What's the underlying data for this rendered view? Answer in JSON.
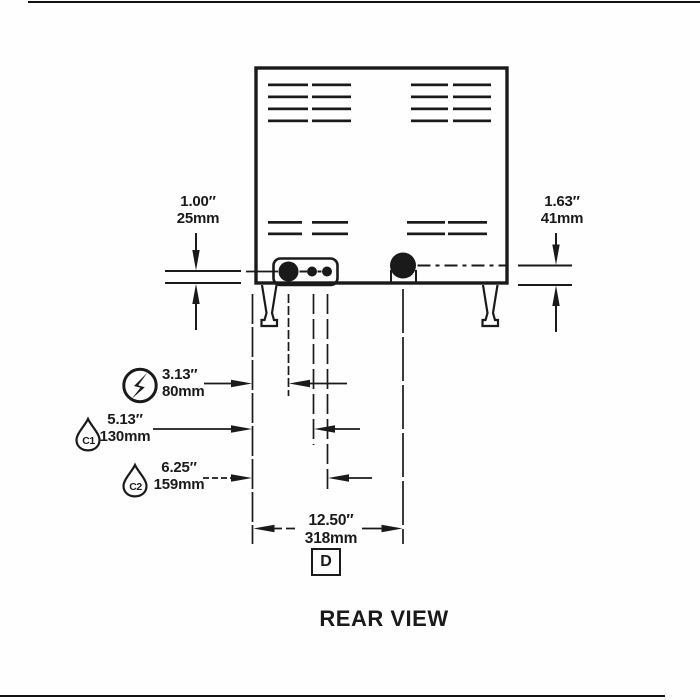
{
  "page": {
    "title": "REAR VIEW"
  },
  "detail_ref": "D",
  "dims": {
    "left": {
      "inches": "1.00″",
      "metric": "25mm"
    },
    "right": {
      "inches": "1.63″",
      "metric": "41mm"
    },
    "electrical": {
      "inches": "3.13″",
      "metric": "80mm"
    },
    "c1": {
      "inches": "5.13″",
      "metric": "130mm"
    },
    "c2": {
      "inches": "6.25″",
      "metric": "159mm"
    },
    "width": {
      "inches": "12.50″",
      "metric": "318mm"
    }
  },
  "icons": {
    "electrical": "lightning-bolt",
    "c1": "C1",
    "c2": "C2"
  },
  "colors": {
    "ink": "#1a1a1a",
    "paper": "#ffffff"
  }
}
